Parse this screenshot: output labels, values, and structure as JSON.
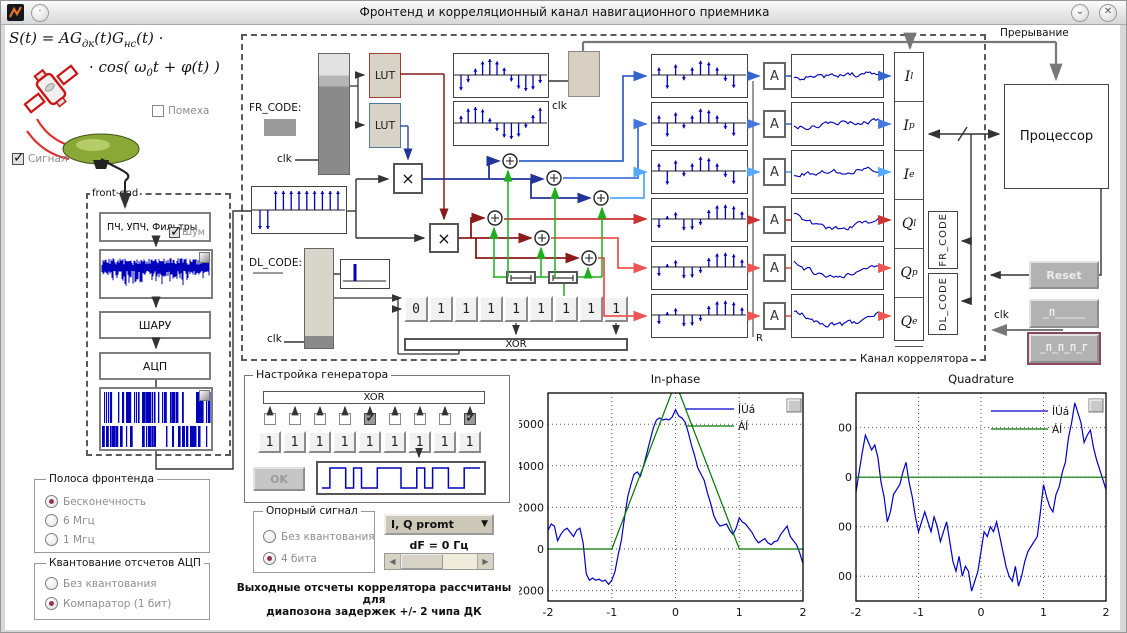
{
  "window": {
    "title": "Фронтенд и корреляционный канал навигационного приемника",
    "shade_glyph": "⌄",
    "close_glyph": "✕"
  },
  "formula": {
    "p1": "S(t) = AG",
    "sub1": "дк",
    "p2": "(t)G",
    "sub2": "нс",
    "p3": "(t) ·",
    "l2p1": "· cos( ω",
    "l2sub": "0",
    "l2p2": "t + φ(t) )"
  },
  "checkboxes": {
    "pomeha": "Помеха",
    "signal": "Сигнал",
    "noise": "Шум"
  },
  "frontend": {
    "label": "front-end",
    "blocks": [
      "ПЧ, УПЧ, Фильтры",
      "ШАРУ",
      "АЦП"
    ]
  },
  "band_group": {
    "title": "Полоса фронтенда",
    "options": [
      {
        "label": "Бесконечность",
        "selected": true
      },
      {
        "label": "6 Мгц",
        "selected": false
      },
      {
        "label": "1 Мгц",
        "selected": false
      }
    ]
  },
  "quant_group": {
    "title": "Квантование отсчетов АЦП",
    "options": [
      {
        "label": "Без квантования",
        "selected": false
      },
      {
        "label": "Компаратор (1 бит)",
        "selected": true
      }
    ]
  },
  "correlator": {
    "label": "Канал коррелятора",
    "fr_code": "FR_CODE:",
    "dl_code": "DL_CODE:",
    "clk": "clk",
    "lut": "LUT",
    "xor": "XOR",
    "mult": "×",
    "acc": "A",
    "reset_flag": "R",
    "shift_register": [
      "0",
      "1",
      "1",
      "1",
      "1",
      "1",
      "1",
      "1",
      "1"
    ],
    "outputs": [
      {
        "main": "I",
        "sub": "l"
      },
      {
        "main": "I",
        "sub": "p"
      },
      {
        "main": "I",
        "sub": "e"
      },
      {
        "main": "Q",
        "sub": "l"
      },
      {
        "main": "Q",
        "sub": "p"
      },
      {
        "main": "Q",
        "sub": "e"
      }
    ],
    "vertical_boxes": [
      "FR_CODE",
      "DL_CODE"
    ]
  },
  "right": {
    "interrupt": "Прерывание",
    "processor": "Процессор",
    "reset": "Reset",
    "clk": "clk",
    "pulse1": "_П_____",
    "pulse2": "_П_П_П_Г"
  },
  "generator": {
    "title": "Настройка генератора",
    "xor": "XOR",
    "ok": "OK",
    "cells": [
      "1",
      "1",
      "1",
      "1",
      "1",
      "1",
      "1",
      "1",
      "1"
    ],
    "taps": [
      false,
      false,
      false,
      false,
      true,
      false,
      false,
      false,
      true
    ]
  },
  "reference_group": {
    "title": "Опорный сигнал",
    "options": [
      {
        "label": "Без квантования",
        "selected": false
      },
      {
        "label": "4 бита",
        "selected": true
      }
    ]
  },
  "output_select": {
    "value": "I, Q promt"
  },
  "df_label": "dF = 0 Гц",
  "note_line1": "Выходные отсчеты коррелятора рассчитаны для",
  "note_line2": "диапозона задержек +/- 2 чипа ДК",
  "colors": {
    "stem_blue": "#0000bb",
    "wire_dark_blue": "#223399",
    "wire_dark_red": "#8b1a1a",
    "row_blue": [
      "#3366cc",
      "#4477dd",
      "#55aaff"
    ],
    "row_red": [
      "#cc3333",
      "#ee5555",
      "#ee5555"
    ],
    "green": "#1fae1f",
    "radio_dot": "#99335c"
  },
  "decor": {
    "sine1": [
      -0.95,
      -0.45,
      0.4,
      0.85,
      1,
      0.85,
      0.45,
      -0.4,
      -0.85,
      -1,
      -0.9,
      -0.5
    ],
    "sine2": [
      0.45,
      0.9,
      1,
      0.85,
      0.3,
      -0.5,
      -0.9,
      -1,
      -0.85,
      -0.3,
      0.5,
      0.95
    ],
    "code": [
      -1,
      -1,
      1,
      1,
      1,
      1,
      1,
      1,
      1,
      1,
      1
    ],
    "stems_i": [
      0.5,
      -0.9,
      0.7,
      -0.35,
      0.5,
      0.95,
      0.85,
      0.5,
      -0.4,
      -0.85
    ],
    "stems_q": [
      -0.6,
      0.2,
      0.45,
      -0.75,
      -0.7,
      -0.4,
      0.6,
      0.9,
      0.95,
      0.85,
      0.5
    ],
    "gen_wave": [
      0,
      1,
      1,
      0,
      1,
      0,
      0,
      1,
      1,
      1,
      0,
      0,
      1,
      0,
      1,
      1,
      0,
      0,
      1,
      1
    ]
  },
  "chart_data": [
    {
      "type": "line",
      "title": "In-phase",
      "xlabel": "",
      "ylabel": "",
      "xlim": [
        -2,
        2
      ],
      "ylim": [
        -2500,
        7500
      ],
      "xticks": [
        -2,
        -1,
        0,
        1,
        2
      ],
      "yticks": [
        -2000,
        0,
        2000,
        4000,
        6000
      ],
      "grid": true,
      "legend_position": "top-right",
      "series": [
        {
          "name": "ÍÚá",
          "color": "#0000cc",
          "x_start": -2,
          "x_step": 0.05,
          "y": [
            900,
            1200,
            1100,
            400,
            700,
            900,
            1000,
            800,
            600,
            900,
            1000,
            300,
            -1200,
            -1500,
            -1400,
            -1500,
            -1450,
            -1550,
            -1500,
            -1700,
            -1500,
            -1100,
            -300,
            400,
            1500,
            2500,
            3100,
            3600,
            3700,
            3500,
            4000,
            4600,
            5200,
            5800,
            6200,
            6300,
            6200,
            6250,
            6200,
            6350,
            6700,
            6400,
            6300,
            6100,
            5600,
            5000,
            4500,
            3900,
            3600,
            3300,
            2700,
            2200,
            1600,
            1300,
            1100,
            1150,
            1200,
            900,
            700,
            1000,
            1500,
            1300,
            1200,
            1000,
            800,
            500,
            300,
            400,
            500,
            300,
            200,
            350,
            400,
            700,
            900,
            1100,
            600,
            400,
            200,
            -200,
            -700
          ]
        },
        {
          "name": "ÁÍ",
          "color": "#007700",
          "x": [
            -2,
            -1,
            0,
            1,
            2
          ],
          "y": [
            0,
            0,
            8000,
            0,
            0
          ]
        }
      ]
    },
    {
      "type": "line",
      "title": "Quadrature",
      "xlabel": "",
      "ylabel": "",
      "xlim": [
        -2,
        2
      ],
      "ylim": [
        -2500,
        1700
      ],
      "xticks": [
        -2,
        -1,
        0,
        1,
        2
      ],
      "yticks": [
        -2000,
        -1000,
        0,
        1000
      ],
      "grid": true,
      "legend_position": "top-right",
      "series": [
        {
          "name": "ÍÚá",
          "color": "#0000cc",
          "x_start": -2,
          "x_step": 0.05,
          "y": [
            -300,
            100,
            500,
            850,
            700,
            550,
            650,
            400,
            -100,
            -400,
            -900,
            -700,
            -350,
            -250,
            -150,
            100,
            300,
            -100,
            -400,
            -800,
            -1100,
            -900,
            -700,
            -900,
            -1100,
            -800,
            -1000,
            -1300,
            -1100,
            -900,
            -1300,
            -1700,
            -1900,
            -1600,
            -2000,
            -1800,
            -1900,
            -2300,
            -2100,
            -1900,
            -1500,
            -1100,
            -1200,
            -1000,
            -1100,
            -900,
            -1200,
            -1500,
            -1800,
            -2000,
            -2100,
            -1800,
            -2200,
            -2000,
            -1700,
            -1500,
            -1400,
            -1300,
            -1200,
            -700,
            -150,
            -400,
            -600,
            -700,
            -350,
            -200,
            100,
            300,
            800,
            1100,
            1500,
            1300,
            1100,
            700,
            850,
            950,
            600,
            350,
            150,
            -50,
            -250
          ]
        },
        {
          "name": "ÁÍ",
          "color": "#007700",
          "x": [
            -2,
            2
          ],
          "y": [
            0,
            0
          ]
        }
      ]
    }
  ]
}
